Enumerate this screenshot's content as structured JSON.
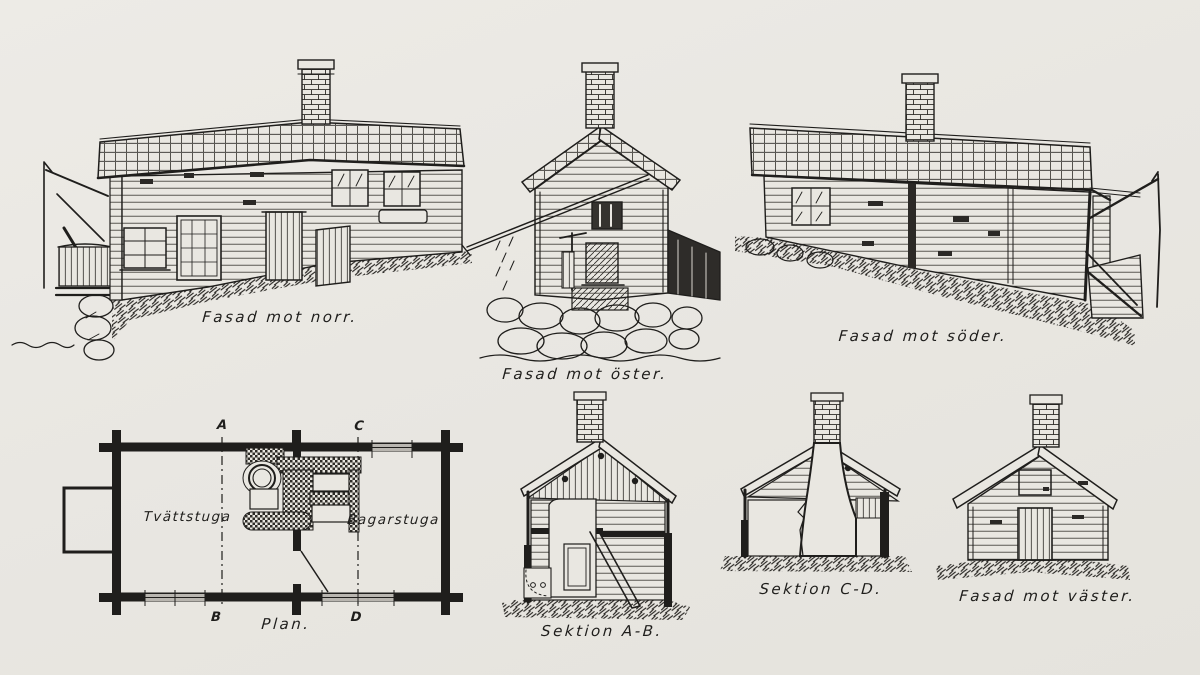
{
  "sheet": {
    "colors": {
      "paper": "#e9e7e2",
      "ink": "#1f1e1c"
    }
  },
  "labels": {
    "facade_north": "Fasad mot norr.",
    "facade_east": "Fasad mot öster.",
    "facade_south": "Fasad mot söder.",
    "plan": "Plan.",
    "section_ab": "Sektion A-B.",
    "section_cd": "Sektion C-D.",
    "facade_west": "Fasad mot väster."
  },
  "plan": {
    "rooms": {
      "left": "Tvättstuga",
      "right": "Bagarstuga"
    },
    "markers": {
      "a": "A",
      "b": "B",
      "c": "C",
      "d": "D"
    }
  }
}
